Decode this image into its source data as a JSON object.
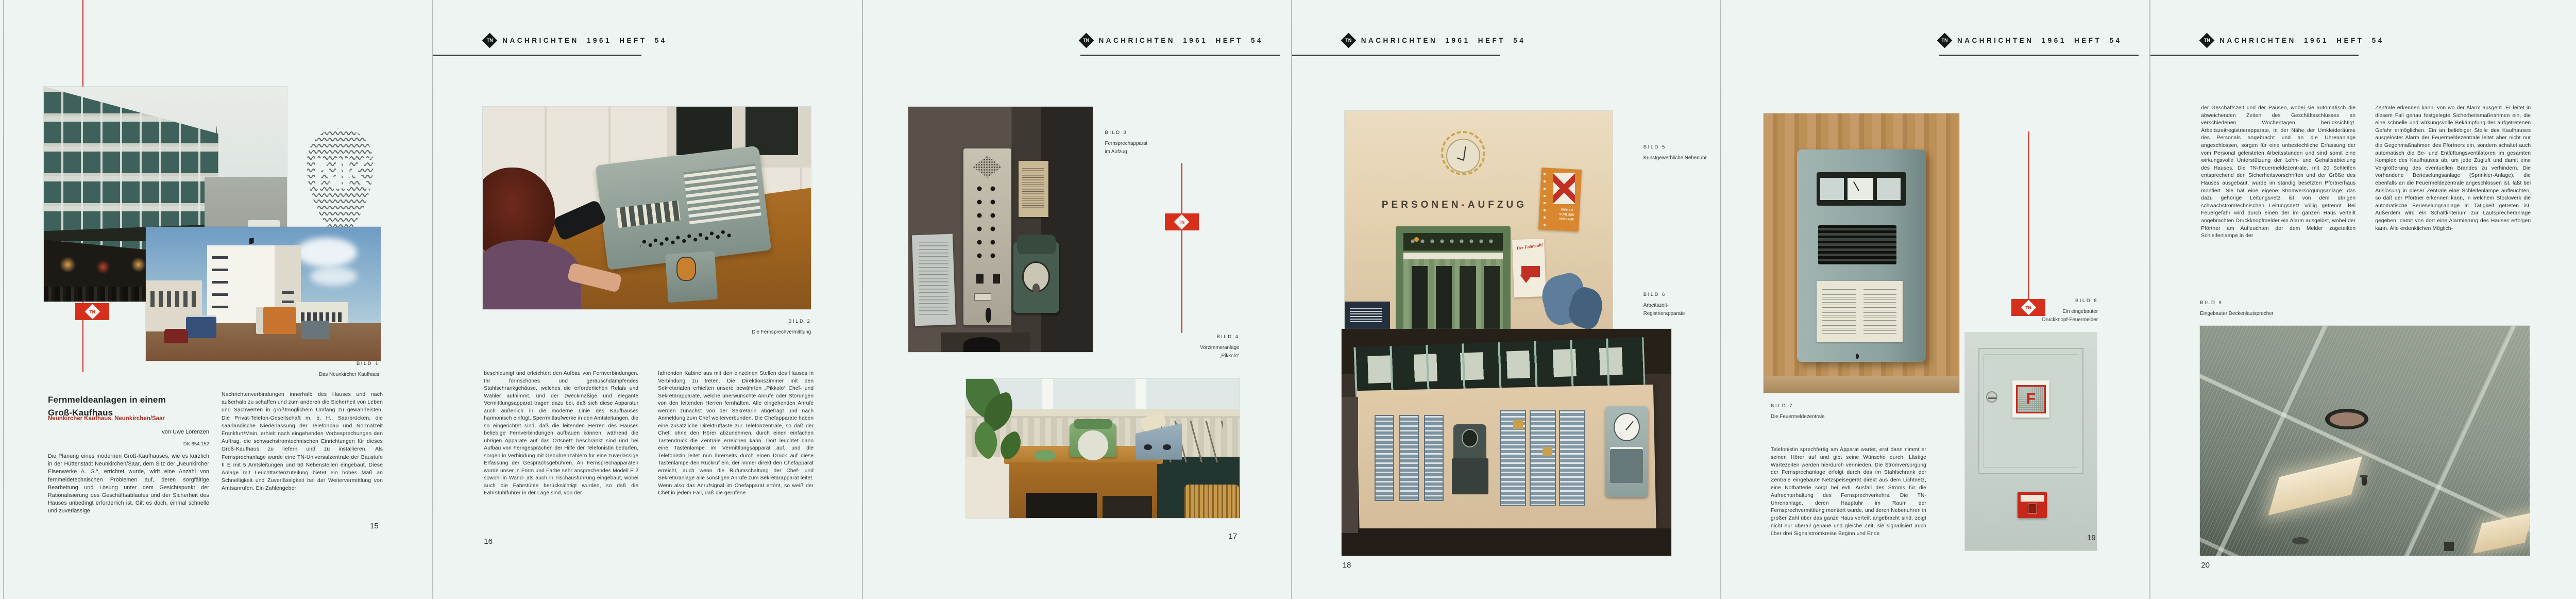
{
  "journal": {
    "masthead": "NACHRICHTEN 1961 HEFT 54"
  },
  "icons": {
    "tn_monogram": "TN",
    "nk_monogram": "NK"
  },
  "colors": {
    "paper": "#edf4f2",
    "accent_red": "#d6301d",
    "rule_dark": "#3b403d",
    "ink": "#2c2e2c",
    "subtitle_red": "#ab3326"
  },
  "pages": [
    {
      "page_number": "15",
      "title_line1": "Fernmeldeanlagen in einem",
      "title_line2": "Groß-Kaufhaus",
      "subtitle": "Neunkircher Kaufhaus, Neunkirchen/Saar",
      "byline": "von Uwe Lorenzen",
      "dk": "DK 654.152",
      "bild1": {
        "label": "BILD 1",
        "caption": "Das Neunkircher Kaufhaus"
      },
      "col1": "Die Planung eines modernen Groß-Kaufhauses, wie es kürzlich in der Hüttenstadt Neunkirchen/Saar, dem Sitz der „Neunkircher Eisenwerke A. G.“, errichtet wurde, wirft eine Anzahl von fernmeldetechnischen Problemen auf, deren sorgfältige Bearbeitung und Lösung unter dem Gesichtspunkt der Rationalisierung des Geschäftsablaufes und der Sicherheit des Hauses unbedingt erforderlich ist. Gilt es doch, einmal schnelle und zuverlässige",
      "col2": "Nachrichtenverbindungen innerhalb des Hauses und nach außerhalb zu schaffen und zum anderen die Sicherheit von Leben und Sachwerten in größtmöglichem Umfang zu gewährleisten. Die Privat-Telefon-Gesellschaft m. b. H., Saarbrücken, die saarländische Niederlassung der Telefonbau und Normalzeit Frankfurt/Main, erhielt nach eingehenden Vorbesprechungen den Auftrag, die schwachstromtechnischen Einrichtungen für dieses Groß-Kaufhaus zu liefern und zu installieren. Als Fernsprechanlage wurde eine TN-Universalzentrale der Baustufe II E mit 5 Amtsleitungen und 50 Nebenstellen eingebaut. Diese Anlage mit Leuchttastenzuteilung bietet ein hohes Maß an Schnelligkeit und Zuverlässigkeit bei der Weitervermittlung von Amtsanrufen. Ein Zahlengeber"
    },
    {
      "page_number": "16",
      "bild2": {
        "label": "BILD 2",
        "caption": "Die Fernsprechvermittlung"
      },
      "col1": "beschleunigt und erleichtert den Aufbau von Fernverbindungen. Ihr formschönes und geräuschdämpfendes Stahlschrankgehäuse, welches die erforderlichen Relais und Wähler aufnimmt, und der zweckmäßige und elegante Vermittlungsapparat tragen dazu bei, daß sich diese Apparatur auch äußerlich in die moderne Linie des Kaufhauses harmonisch einfügt. Sperrmitlaufwerke in den Amtsleitungen, die so eingerichtet sind, daß die leitenden Herren des Hauses beliebige Fernverbindungen aufbauen können, während die übrigen Apparate auf das Ortsnetz beschränkt sind und bei Aufbau von Ferngesprächen der Hilfe der Telefonistin bedürfen, sorgen in Verbindung mit Gebührenzählern für eine zuverlässige Erfassung der Gesprächsgebühren. An Fernsprechapparaten wurde unser in Form und Farbe sehr ansprechendes Modell E 2 sowohl in Wand- als auch in Tischausführung eingebaut, wobei auch die Fahrstühle berücksichtigt wurden, so daß die Fahrstuhlführer in der Lage sind, von der",
      "col2": "fahrenden Kabine aus mit den einzelnen Stellen des Hauses in Verbindung zu treten. Die Direktionszimmer mit den Sekretariaten erhielten unsere bewährten „Pikkolo“ Chef- und Sekretärapparate, welche unerwünschte Anrufe oder Störungen von den leitenden Herren fernhalten. Alle eingehenden Anrufe werden zunächst von der Sekretärin abgefragt und nach Anmeldung zum Chef weiterverbunden. Die Chefapparate haben eine zusätzliche Direktruftaste zur Telefonzentrale, so daß der Chef, ohne den Hörer abzunehmen, durch einen einfachen Tastendruck die Zentrale erreichen kann. Dort leuchtet dann eine Tastenlampe im Vermittlungsapparat auf, und die Telefonistin leitet nun ihrerseits durch einen Druck auf diese Tastenlampe den Rückruf ein, der immer direkt den Chefapparat erreicht, auch wenn die Rufumschaltung der Chef- und Sekretäranlage alle sonstigen Anrufe zum Sekretärapparat leitet. Wenn also das Anrufsignal im Chefapparat ertönt, so weiß der Chef in jedem Fall, daß die gerufene"
    },
    {
      "page_number": "17",
      "bild3": {
        "label": "BILD 3",
        "lines": [
          "Fernsprechapparat",
          "im Aufzug"
        ]
      },
      "bild4": {
        "label": "BILD 4",
        "lines": [
          "Vorzimmeranlage",
          "„Pikkolo“"
        ]
      }
    },
    {
      "page_number": "18",
      "bild5": {
        "label": "BILD 5",
        "caption": "Kunstgewerbliche Nebenuhr"
      },
      "bild6": {
        "label": "BILD 6",
        "lines": [
          "Arbeitszeit-",
          "Registrierapparate"
        ]
      },
      "photo_texts": {
        "sign": "PERSONEN-AUFZUG",
        "poster": "WINTER SCHLUSS VERKAUF",
        "fahrstuhl": "Der Fahrstuhl"
      }
    },
    {
      "page_number": "19",
      "bild7": {
        "label": "BILD 7",
        "caption": "Die Feuermeldezentrale"
      },
      "bild8": {
        "label": "BILD 8",
        "lines": [
          "Ein eingebauter",
          "Druckknopf-Feuermelder"
        ]
      },
      "photo_texts": {
        "f": "F"
      },
      "col1": "Telefonistin sprechfertig am Apparat wartet, erst dann nimmt er seinen Hörer auf und gibt seine Wünsche durch. Lästige Wartezeiten werden hierdurch vermieden. Die Stromversorgung der Fernsprechanlage erfolgt durch das im Stahlschrank der Zentrale eingebaute Netzspeisegerät direkt aus dem Lichtnetz, eine Notbatterie sorgt bei evtl. Ausfall des Stroms für die Aufrechterhaltung des Fernsprechverkehrs. Die TN-Uhrenanlage, deren Hauptuhr im Raum der Fernsprechvermittlung montiert wurde, und deren Nebenuhren in großer Zahl über das ganze Haus verteilt angebracht sind, zeigt nicht nur überall genaue und gleiche Zeit, sie signalisiert auch über drei Signalstromkreise Beginn und Ende"
    },
    {
      "page_number": "20",
      "bild9": {
        "label": "BILD 9",
        "caption": "Eingebauter Deckenlautsprecher"
      },
      "col1": "der Geschäftszeit und der Pausen, wobei sie automatisch die abweichenden Zeiten des Geschäftsschlusses an verschiedenen Wochentagen berücksichtigt. Arbeitszeitregistrierapparate, in der Nähe der Umkleideräume des Personals angebracht und an die Uhrenanlage angeschlossen, sorgen für eine unbestechliche Erfassung der vom Personal geleisteten Arbeitsstunden und sind somit eine wirkungsvolle Unterstützung der Lohn- und Gehaltsabteilung des Hauses. Die TN-Feuermeldezentrale, mit 20 Schleifen entsprechend den Sicherheitsvorschriften und der Größe des Hauses ausgebaut, wurde im ständig besetzten Pförtnerhaus montiert. Sie hat eine eigene Stromversorgungsanlage; das dazu gehörige Leitungsnetz ist von dem übrigen schwachstromtechnischen Leitungsnetz völlig getrennt. Bei Feuergefahr wird durch einen der im ganzen Haus verteilt angebrachten Druckknopfmelder ein Alarm ausgelöst, wobei der Pförtner am Aufleuchten der dem Melder zugeteilten Schleifenlampe in der",
      "col2": "Zentrale erkennen kann, von wo der Alarm ausgeht. Er leitet in diesem Fall genau festgelegte Sicherheitsmaßnahmen ein, die eine schnelle und wirkungsvolle Bekämpfung der aufgetretenen Gefahr ermöglichen. Ein an beliebiger Stelle des Kaufhauses ausgelöster Alarm der Feuermeldezentrale leitet aber nicht nur die Gegenmaßnahmen des Pförtners ein, sondern schaltet auch automatisch die Be- und Entlüftungsventilatoren im gesamten Komplex des Kaufhauses ab, um jede Zugluft und damit eine Vergrößerung des eventuellen Brandes zu verhindern. Die vorhandene Berieselungsanlage (Sprinkler-Anlage), die ebenfalls an die Feuermeldezentrale angeschlossen ist, läßt bei Auslösung in dieser Zentrale eine Schleifenlampe aufleuchten, so daß der Pförtner erkennen kann, in welchem Stockwerk die automatische Berieselungsanlage in Tätigkeit getreten ist. Außerdem wird ein Schaltkriterium zur Lautsprecheranlage gegeben, damit von dort eine Alarmierung des Hauses erfolgen kann. Alle erdenklichen Möglich-"
    },
    {
      "page_number": "21",
      "bild10": {
        "label": "BILD 10",
        "lines": [
          "Wandlautsprecher",
          "der elektro-akustischen Rufanlage"
        ]
      },
      "photo_texts": {
        "ausgang": "Ausgang",
        "rauchen": "Rauchen nicht erlaubt",
        "nur": "NUR",
        "notausgang": "NOTAUSGANG"
      },
      "col1": "keiten wurden berücksichtigt, um die Sicherheit des Hauses, des Publikums und des Personals bei Feuergefahr zu gewährleisten. Die elektro-akustische Rufanlage, in Zusammenarbeit mit der Firma Telefunken entwickelt, ist recht umfangreich. Sie umfaßt neben der Verstärkerzentrale über 100 im Hause verteilte Lautsprecher, die z. T. in die Decken eingebaut wurden. Anschlüsse für Mikrofone in den verschiedenen Abteilungen des Hauses und die Möglichkeit, in einzelnen Abteilungen, getrennt von den anderen, Sonderprogramme mittels eines Übertragungswagens aussenden zu können, sind ebenfalls vorhanden. Mikrofone mit der Möglichkeit der Sammelschaltung (Kommandoschaltung) wurden in der Telefonzentrale und bei den leitenden Direktoren installiert. Über diese Mikrofone können alle Lautsprecher angesprochen werden, gleichgültig, ob diese in einzelnen Abteilungen abgeschaltet sind oder ein Einzelprogramm abstrahlen. Auch die von der Hauptuhr der Uhrenanlage abgegebenen",
      "col2": "Signale für Beginn und Ende der Geschäftszeit und der Pausen werden durch eine Gongschlageinrichtung in Verbindung mit der Verstärkerzentrale über die Lautsprecher ausgestrahlt. Auch die Signalgabe bei Fernalarm erfolgt von der Feuermeldeanlage her über die Lautsprecheranlage. In diesem Fall werden alle sonstigen Programme der elektro-akustischen Rufanlage automatisch abgeschaltet (Vorrangschaltung). An verschiedenen Stellen des Hauses, besonders jedoch in den Verkaufsabteilungen für Rundfunk- und Fernsehgeräte und in Schaufenstern können Rundfunk- und Fernsehgeräte über Spezialsteckdosen an eine umfangreiche Antennenanlage mit den Wellenbereichen Lang - Mittel - Kurz - UKW und Fernsehen angeschlossen werden, so daß die Programme einwandfrei empfangen werden können. Die Antennenverstärker wurden neben der Telefonzentrale montiert, so daß sie leicht zugänglich sind und ohne Schwierigkeit gewartet werden können."
    },
    {
      "page_number": "22",
      "bild11": {
        "label": "BILD 11",
        "lines": [
          "Rapidofon-Hausfernsprecher",
          "in der Kühlvitrine"
        ]
      },
      "col1": "Kühlvitrinen in der Lebensmittelabteilung des Kaufhauses nehmen leichtverderbliche Lebensmittel auf. Es lag nahe, hier durch eine besondere Überwachungseinrichtung ständig die Temperaturen in den Vitrinen kontrollieren zu lassen, damit Abweichungen von der vorgeschriebenen Temperaturhöhe sofort signalisiert und Abhilfemaßnahmen eingeleitet werden können. Mit Thermoschaltern und Anzeigetablos, welche sowohl optisch über Lampen als auch akustisch über Summer Temperaturabweichungen signalisieren, werden der einwandfreie Betrieb der Kühlaggregate überwacht und Störungen für jede Kühlvitrine getrennt angezeigt. Eine automatische Verkehrssignal-Anlage für ein- und ausfahrende Kraftfahrzeuge regelt den Verkehr auf der einspurigen Zufahrt zum Parkplatz. Dabei wird die erforderliche Steuerung der Lichtsignale von den Kraftfahrzeugen durch Überfahren einer Bodenschwelle selbst vorgenommen. Diese Bodenschwellen betätigen Kontakte, welche über",
      "col2": "eine Relaisschaltung die Farben rot, gelb oder grün in den Verkehrsampeln zur Einschaltung bringen. Eine sinnreiche Verzögerungsschaltung sorgt dafür, daß ein noch in Zu- oder Abfahrt befindliches Kraftfahrzeug rechtzeitig die einbahnige Wegstrecke verlassen kann, bevor das wartende Fahrzeug grünes Signal erhält. Naturgemäß konnte im begrenzten Rahmen dieser Abhandlung nur in großen Zügen auf die einzelnen fernmeldetechnischen Anlagen eingegangen werden, jedoch wollte die vorliegende Beschreibung einen Überblick über den vielseitigen Anwendungsbereich von Fernmeldeanlagen geben und damit deren Bedeutung für den rationellen Betriebsablauf in einem Kaufhaus aufzeigen."
    }
  ]
}
